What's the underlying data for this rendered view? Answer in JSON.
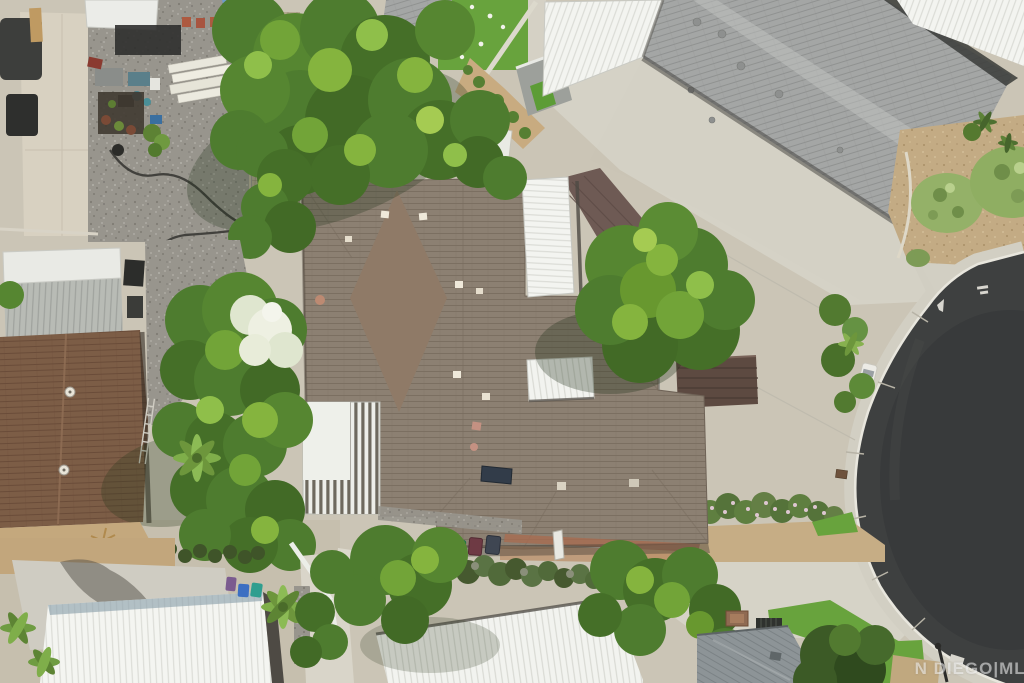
{
  "image": {
    "type": "aerial-drone-photo",
    "subject": "single-story home with brown shingle roof, white patio covers and lattice pergola",
    "setting": "suburban cul-de-sac neighborhood, top-down view"
  },
  "watermark": {
    "text": "N DIEGO|MLS"
  },
  "road": {
    "surface": "dark asphalt cul-de-sac",
    "markings": [
      "white painted arrow",
      "white curb stencil"
    ],
    "curb_color": "#e8e6dd"
  },
  "objects": {
    "rear_trash_bins": [
      "green",
      "maroon",
      "dark gray"
    ],
    "street_trash_bins": [
      "purple",
      "blue",
      "teal"
    ],
    "flag": "american flag on neighbor house",
    "yard_items": [
      "lumber stack",
      "patio furniture",
      "garden hose",
      "ladder",
      "roof vents",
      "rooftop panel"
    ]
  },
  "palette": {
    "main_roof": "#8c8072",
    "rust_roof": "#7c5d46",
    "gray_shingle": "#a4a6a5",
    "white_metal_roof": "#f3f4f0",
    "asphalt": "#3e4040",
    "concrete": "#d6d3c7",
    "dirt": "#c6ad85",
    "gravel": "#98958d",
    "tree_green": "#4e7c2f",
    "turf_green": "#68a33d"
  }
}
